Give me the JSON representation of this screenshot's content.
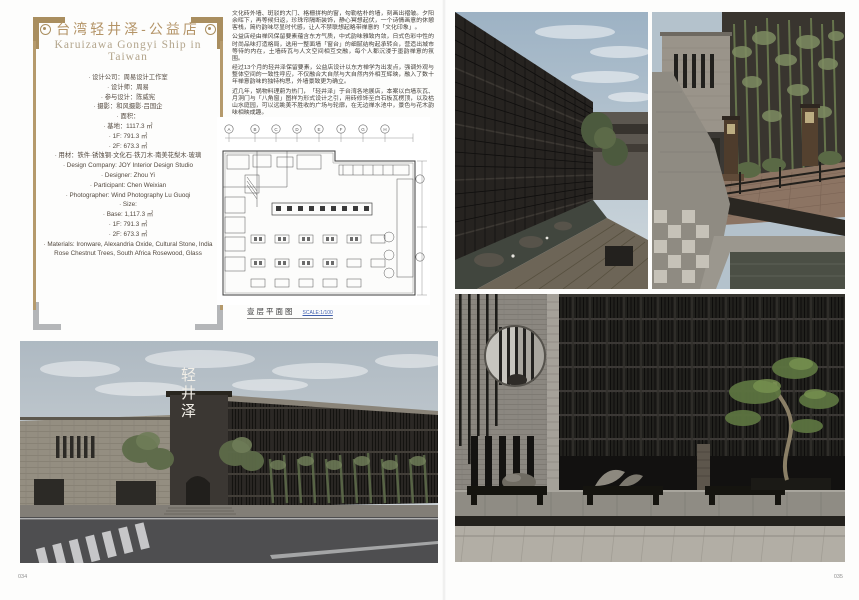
{
  "meta": {
    "page_left_number": "034",
    "page_right_number": "035"
  },
  "title": {
    "cn": "台湾轻井泽-公益店",
    "en": "Karuizawa Gongyi Ship in Taiwan"
  },
  "credits": [
    "· 设计公司：周易设计工作室",
    "· 设计师：周易",
    "· 参与设计：陈威宪",
    "· 摄影：和风摄影·吕国企",
    "· 面积：",
    "· 基地：1117.3 ㎡",
    "· 1F: 791.3 ㎡",
    "· 2F: 673.3 ㎡",
    "· 用材：铁件·锈蚀钢·文化石·铁刀木·南美花梨木·玻璃",
    "· Design Company: JOY Interior Design Studio",
    "· Designer: Zhou Yi",
    "· Participant: Chen Weixian",
    "· Photographer: Wind Photography Lu Guoqi",
    "· Size:",
    "· Base: 1,117.3 ㎡",
    "· 1F: 791.3 ㎡",
    "· 2F: 673.3 ㎡",
    "· Materials: Ironware, Alexandria Oxide, Cultural Stone, India Rose Chestnut Trees, South Africa Rosewood, Glass"
  ],
  "intro": {
    "p1": "文化砖外墙、斑驳的大门、格栅拼构的窗，勾勒枯朴的墙，刻画出褶皱。夕阳余晖下，再等候归返，珍珠帘隔断装饰，静心冥想起伏，一个诗情画意的休憩客栈，简约韵味尽显时代感，让人不禁联想起略带禅意的「文化印象」。",
    "p2": "公益店经由禅风保留要素蕴含东方气质，中式韵味雅致内敛，日式色彩中性的时尚品味打造格局，选用一整面墙「窗台」的细腻结构起承转合，营造出城市等待的内在，土墙砖瓦与人文空间相互交融，每个人都沉浸于墨韵禅意的氛围。",
    "p3": "经过13个月的轻井泽保留要素，公益店设计以东方禅学为出发点，强调外观与整体空间的一致性呼应，不仅融合大自然与大自然内外相互辉映，融入了数十年禅意韵味的独特构思，外墙景致更为确立。",
    "p4": "近几年，锅物料理蔚为热门，「轻井泽」于台湾各地展店，本案以白墙灰瓦、月洞门与「八角窗」图样为形式设计之引，用砖修饰至白石板瓦楞顶，以及枯山水庭园，可以远眺美不胜收的广场与轮廓，在无边禅水池中，景色与花木韵味相映成趣。"
  },
  "plan": {
    "caption": "壹层平面图",
    "scale": "SCALE:1/100",
    "grid_labels": [
      "A",
      "B",
      "C",
      "D",
      "E",
      "F",
      "G",
      "H"
    ]
  },
  "photos": {
    "exterior_sign": "轻井泽"
  },
  "colors": {
    "frame_gold": "#a98e5f",
    "title_gold": "#b49467",
    "subtitle_tan": "#b2a48b",
    "body_text": "#433f3a",
    "scale_blue": "#3f5fae",
    "facade_dark": "#24221f",
    "brick_gray": "#938d80",
    "sky_blue": "#b6c2ca"
  }
}
